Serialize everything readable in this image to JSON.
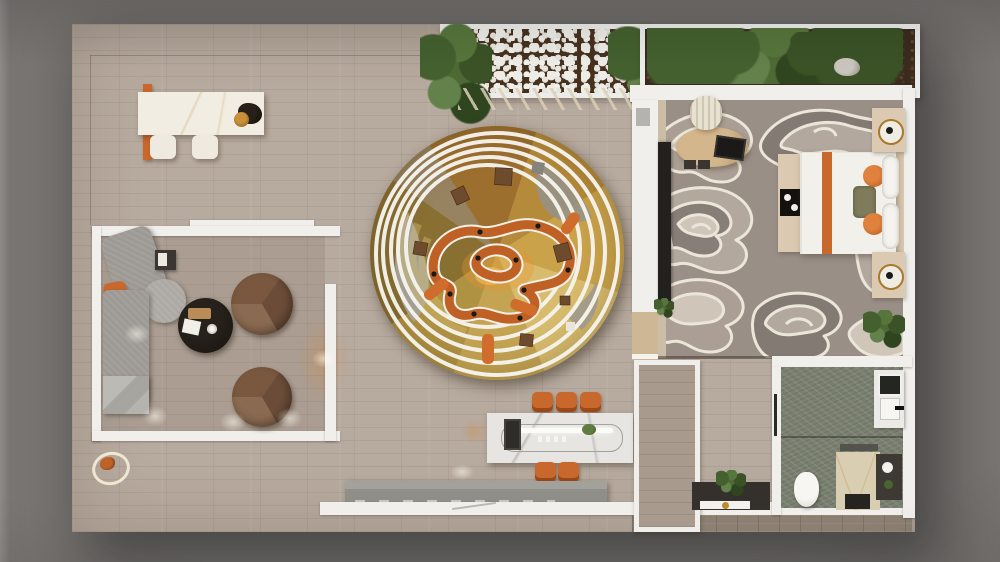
{
  "scene": {
    "type": "top-down 3d architectural floor-plan render",
    "setting": "open-plan apartment / showroom suite",
    "areas": [
      {
        "name": "entry-hall",
        "floor": "beige plank tile",
        "items": [
          "white marble reception table with orange support",
          "two white stools",
          "dark decor piece with gold bowl"
        ]
      },
      {
        "name": "roof-planter-left",
        "items": [
          "white pebble bed",
          "palm plants",
          "slatted walkway below"
        ]
      },
      {
        "name": "roof-planter-right",
        "items": [
          "dense ferns and palms on dark soil",
          "grey rock"
        ]
      },
      {
        "name": "living-lounge",
        "enclosure": "white low partition walls",
        "items": [
          "grey L-sofa with orange cushion",
          "round grey ottoman",
          "marble bench end",
          "black round coffee table with wood tray, papers and cup",
          "two round brown swivel chairs",
          "small dark side table",
          "ceiling light pools on floor"
        ]
      },
      {
        "name": "central-amphitheatre",
        "shape": "large circle",
        "items": [
          "golden segmented floor wedges",
          "terraced seating arcs",
          "five offset white concentric rings",
          "winding orange ribbon track with white rails and black posts",
          "scattered brown stools and chairs",
          "orange lounge benches",
          "grey crescent platforms",
          "warm centre glow"
        ]
      },
      {
        "name": "dining-area",
        "items": [
          "white marble dining table",
          "oval serving rail with white light bar",
          "black coffee machine",
          "small plant",
          "three orange chairs on top side",
          "two orange chairs on bottom side"
        ]
      },
      {
        "name": "bedroom",
        "floor": "cloud-swirl taupe carpet",
        "items": [
          "bed with white duvet, orange runner stripe, olive cushion, two orange discs, white pillows",
          "beige footboard bench with black tray",
          "beige headboard",
          "two nightstands with ring lamps",
          "oval wood desk with black laptop",
          "striped cream desk chair",
          "dark media console with plant",
          "green indoor tree",
          "wood threshold door"
        ]
      },
      {
        "name": "bathroom",
        "floor": "green marble",
        "items": [
          "white toilet",
          "beige marble shower with dark mat",
          "vanity with sink, black faucet and dark mirror",
          "dark storage niche with paper roll and plant"
        ]
      },
      {
        "name": "corridor",
        "items": [
          "white framed closet",
          "dark console with plant, white shelf and gold vase"
        ]
      },
      {
        "name": "south-edge",
        "items": [
          "grey slatted bench",
          "white perimeter wall with door-swing breaks",
          "small fish sculpture on white ring stand"
        ]
      }
    ]
  },
  "palette": {
    "bg-gray": "#787572",
    "floor-tile": "#b7aa9e",
    "wall-white": "#f0efec",
    "accent-orange": "#c9682c",
    "ribbon-orange": "#bf6124",
    "circle-gold": "#b5964a",
    "circle-gold-light": "#d6b765",
    "circle-olive": "#8a762f",
    "carpet-base": "#9a8f87",
    "carpet-light": "#cfc5b9",
    "carpet-dark": "#837b73",
    "marble-white": "#f2ede3",
    "sofa-gray": "#9d9a95",
    "chair-brown": "#7d5e45",
    "table-black": "#17130f",
    "bath-green": "#7a8070",
    "shower-beige": "#d9cdb2",
    "plant-green": "#47602f",
    "soil-brown": "#46311f",
    "bench-gray": "#8f8e89",
    "nightstand-beige": "#dcc9b1",
    "wood-light": "#cdb795"
  }
}
